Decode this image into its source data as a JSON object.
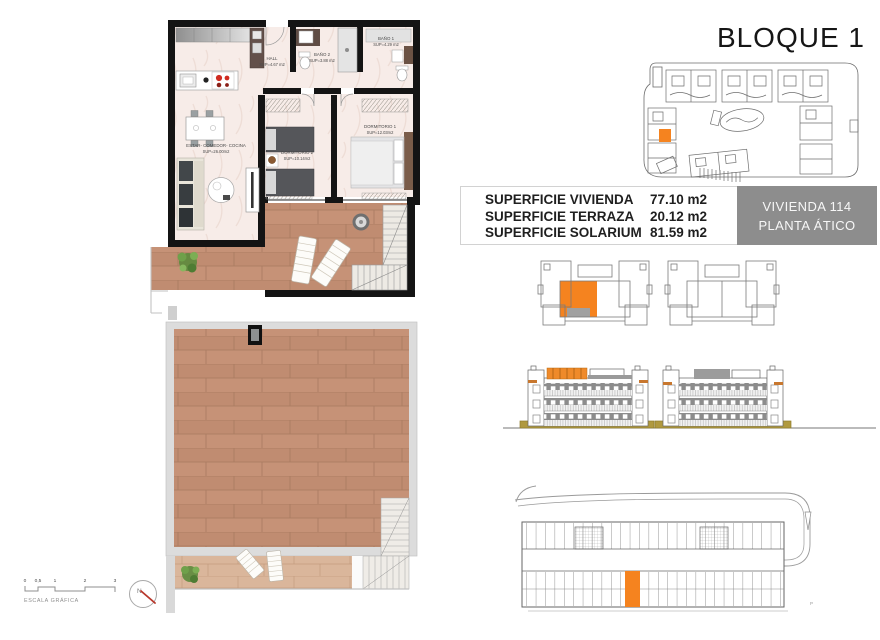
{
  "title": "BLOQUE 1",
  "surface_table": {
    "rows": [
      {
        "label": "SUPERFICIE VIVIENDA",
        "value": "77.10 m2"
      },
      {
        "label": "SUPERFICIE TERRAZA",
        "value": "20.12 m2"
      },
      {
        "label": "SUPERFICIE SOLARIUM",
        "value": "81.59 m2"
      }
    ]
  },
  "unit_badge": {
    "line1": "VIVIENDA 114",
    "line2": "PLANTA ÁTICO"
  },
  "floor_plan": {
    "rooms": [
      {
        "name": "HALL",
        "sup": "SUP=4.67 m2"
      },
      {
        "name": "BAÑO 2",
        "sup": "SUP=3.88 m2"
      },
      {
        "name": "BAÑO 1",
        "sup": "SUP=4.29 m2"
      },
      {
        "name": "ESTAR- COMEDOR- COCINA",
        "sup": "SUP=26.00m2"
      },
      {
        "name": "DORMITORIO 2",
        "sup": "SUP=10.14m2"
      },
      {
        "name": "DORMITORIO 1",
        "sup": "SUP=12.03m2"
      }
    ]
  },
  "scale_bar": {
    "label": "ESCALA GRÁFICA",
    "ticks": [
      "0",
      "0,5",
      "1",
      "2",
      "3"
    ]
  },
  "compass": {
    "north_label": "N"
  },
  "parking": {
    "corner_mark": "P"
  },
  "colors": {
    "highlight_orange": "#f5831f",
    "badge_gray": "#8d8d8d",
    "wood": "#c28f76",
    "floor_pink": "#f6ebe6",
    "ground_olive": "#b0993f",
    "wall_black": "#141414"
  }
}
